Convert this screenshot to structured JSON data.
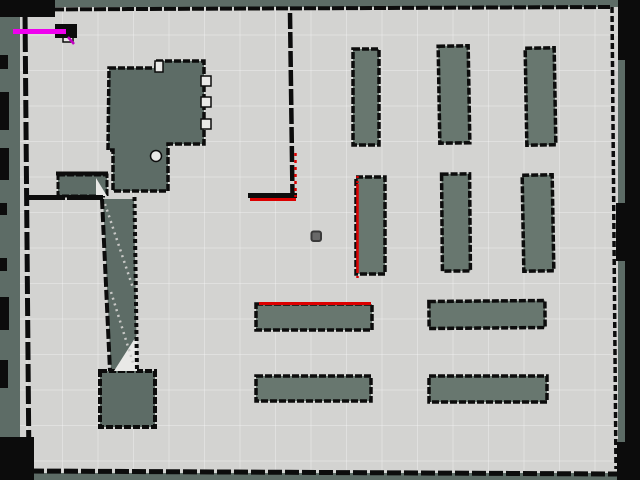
{
  "app": {
    "view": "occupancy-grid-map-view"
  },
  "map": {
    "colors": {
      "unknown": "#5d6c66",
      "floor": "#d3d3d1",
      "shelf": "#68776f",
      "wall": "#0c0c0c",
      "white": "#e9e9e7",
      "laser": "#dc0000",
      "path": "#ee00ee",
      "path_dim": "#c400c4",
      "robot_fill": "#696969",
      "robot_stroke": "#3a3a3a",
      "grid": "rgba(255,255,255,0.30)",
      "diag_dots": "#c9c9c7"
    },
    "viewport": {
      "width": 640,
      "height": 480
    },
    "floor": {
      "x": 20,
      "y": 7,
      "w": 598,
      "h": 466
    },
    "grid": {
      "offset_x": 27,
      "offset_y": 35,
      "spacing": 35.5
    },
    "slate_shapes": [
      {
        "name": "building-structure",
        "type": "path",
        "fill": "unknown",
        "stroke_w": 3.5,
        "d": "M109,68 L156,68 L156,61 L204,61 L204,144 L168,144 L168,191 L113,191 L113,150 L108,150 Z"
      },
      {
        "name": "side-room",
        "type": "rect",
        "fill": "unknown",
        "stroke_w": 3,
        "x": 58,
        "y": 175,
        "w": 49,
        "h": 21
      },
      {
        "name": "corridor-wedge",
        "type": "path",
        "fill": "unknown",
        "stroke_w": 0,
        "d": "M103,199 L134,199 L137,371 L111,371 Z"
      },
      {
        "name": "dock-block",
        "type": "rect",
        "fill": "unknown",
        "stroke_w": 4,
        "x": 100,
        "y": 371,
        "w": 55,
        "h": 56
      },
      {
        "name": "shelf-top-1",
        "type": "rect",
        "fill": "shelf",
        "stroke_w": 3.5,
        "x": 353,
        "y": 49,
        "w": 26,
        "h": 96
      },
      {
        "name": "shelf-top-2",
        "type": "rect",
        "fill": "shelf",
        "stroke_w": 3.5,
        "x": 439,
        "y": 46,
        "w": 30,
        "h": 97,
        "rot": -1
      },
      {
        "name": "shelf-top-3",
        "type": "rect",
        "fill": "shelf",
        "stroke_w": 3.5,
        "x": 526,
        "y": 48,
        "w": 29,
        "h": 97,
        "rot": -1
      },
      {
        "name": "shelf-mid-1",
        "type": "rect",
        "fill": "shelf",
        "stroke_w": 3.5,
        "x": 356,
        "y": 177,
        "w": 29,
        "h": 97
      },
      {
        "name": "shelf-mid-2",
        "type": "rect",
        "fill": "shelf",
        "stroke_w": 3.5,
        "x": 442,
        "y": 174,
        "w": 28,
        "h": 97,
        "rot": -0.5
      },
      {
        "name": "shelf-mid-3",
        "type": "rect",
        "fill": "shelf",
        "stroke_w": 3.5,
        "x": 523,
        "y": 175,
        "w": 30,
        "h": 96,
        "rot": -1
      },
      {
        "name": "shelf-low-1",
        "type": "rect",
        "fill": "shelf",
        "stroke_w": 3.5,
        "x": 256,
        "y": 304,
        "w": 116,
        "h": 26
      },
      {
        "name": "shelf-low-2",
        "type": "rect",
        "fill": "shelf",
        "stroke_w": 3.5,
        "x": 429,
        "y": 301,
        "w": 116,
        "h": 27,
        "rot": -0.5
      },
      {
        "name": "shelf-bottom-1",
        "type": "rect",
        "fill": "shelf",
        "stroke_w": 3.5,
        "x": 256,
        "y": 376,
        "w": 115,
        "h": 25
      },
      {
        "name": "shelf-bottom-2",
        "type": "rect",
        "fill": "shelf",
        "stroke_w": 3.5,
        "x": 429,
        "y": 376,
        "w": 118,
        "h": 26
      }
    ],
    "white_shapes": [
      {
        "name": "structure-door-notch-1",
        "type": "rect",
        "x": 201,
        "y": 76,
        "w": 10,
        "h": 10
      },
      {
        "name": "structure-door-notch-2",
        "type": "rect",
        "x": 201,
        "y": 97,
        "w": 10,
        "h": 10
      },
      {
        "name": "structure-door-notch-3",
        "type": "rect",
        "x": 201,
        "y": 119,
        "w": 10,
        "h": 10
      },
      {
        "name": "structure-top-notch",
        "type": "rect",
        "x": 155,
        "y": 61,
        "w": 8,
        "h": 11
      },
      {
        "name": "structure-round-notch",
        "type": "circle",
        "cx": 156,
        "cy": 156,
        "r": 5.5
      },
      {
        "name": "corridor-triangle",
        "type": "path",
        "d": "M114,371 L137,335 L137,371 Z"
      },
      {
        "name": "side-room-triangle",
        "type": "path",
        "d": "M96,178 L107,196 L96,196 Z"
      },
      {
        "name": "path-end-notch",
        "type": "rect",
        "x": 63,
        "y": 31,
        "w": 10,
        "h": 11
      }
    ],
    "dotted_diagonals": [
      {
        "name": "corridor-scan-diagonal-1",
        "x1": 105,
        "y1": 204,
        "x2": 133,
        "y2": 288
      },
      {
        "name": "corridor-scan-diagonal-2",
        "x1": 111,
        "y1": 292,
        "x2": 134,
        "y2": 366
      }
    ],
    "walls": [
      {
        "name": "wall-top",
        "x1": 24,
        "y1": 9.5,
        "x2": 612,
        "y2": 7,
        "w": 4,
        "dash": "12 2"
      },
      {
        "name": "wall-right",
        "x1": 612,
        "y1": 7,
        "x2": 616,
        "y2": 469,
        "w": 3.5,
        "dash": "6 3"
      },
      {
        "name": "wall-bottom",
        "x1": 30,
        "y1": 471,
        "x2": 617,
        "y2": 474,
        "w": 5,
        "dash": "14 3"
      },
      {
        "name": "wall-left",
        "x1": 25,
        "y1": 12,
        "x2": 29,
        "y2": 470,
        "w": 5,
        "dash": "18 4"
      },
      {
        "name": "wall-center-vertical",
        "x1": 290,
        "y1": 13,
        "x2": 292.5,
        "y2": 196,
        "w": 4.5,
        "dash": "16 3"
      },
      {
        "name": "wall-l-corner-horizontal",
        "x1": 248,
        "y1": 195.5,
        "x2": 297,
        "y2": 195.5,
        "w": 5,
        "dash": ""
      },
      {
        "name": "wall-left-room-top",
        "x1": 25,
        "y1": 197.5,
        "x2": 103,
        "y2": 197.5,
        "w": 5,
        "dash": "40 2"
      },
      {
        "name": "wall-side-room-top",
        "x1": 56,
        "y1": 173.5,
        "x2": 108,
        "y2": 173.5,
        "w": 4,
        "dash": ""
      },
      {
        "name": "wall-corridor-left",
        "x1": 102,
        "y1": 199,
        "x2": 110,
        "y2": 371,
        "w": 4,
        "dash": "10 3"
      },
      {
        "name": "wall-corridor-right",
        "x1": 134.5,
        "y1": 197,
        "x2": 137,
        "y2": 372,
        "w": 4,
        "dash": "4 3"
      }
    ],
    "frame_patches": [
      {
        "name": "frame-top-left",
        "x": 0,
        "y": 0,
        "w": 55,
        "h": 17
      },
      {
        "name": "frame-left-1",
        "x": 0,
        "y": 55,
        "w": 8,
        "h": 14
      },
      {
        "name": "frame-left-2",
        "x": 0,
        "y": 92,
        "w": 9,
        "h": 38
      },
      {
        "name": "frame-left-3",
        "x": 0,
        "y": 148,
        "w": 9,
        "h": 32
      },
      {
        "name": "frame-left-4",
        "x": 0,
        "y": 203,
        "w": 7,
        "h": 12
      },
      {
        "name": "frame-left-5",
        "x": 0,
        "y": 258,
        "w": 7,
        "h": 13
      },
      {
        "name": "frame-left-6",
        "x": 0,
        "y": 297,
        "w": 9,
        "h": 33
      },
      {
        "name": "frame-left-7",
        "x": 0,
        "y": 360,
        "w": 8,
        "h": 28
      },
      {
        "name": "frame-bottom-left-corner",
        "x": 0,
        "y": 437,
        "w": 34,
        "h": 43
      },
      {
        "name": "frame-right-band",
        "x": 625,
        "y": 0,
        "w": 15,
        "h": 480
      },
      {
        "name": "frame-top-right",
        "x": 618,
        "y": 0,
        "w": 22,
        "h": 60
      },
      {
        "name": "frame-right-mid",
        "x": 616,
        "y": 203,
        "w": 12,
        "h": 58
      },
      {
        "name": "frame-bottom-right",
        "x": 617,
        "y": 442,
        "w": 23,
        "h": 38
      },
      {
        "name": "wall-blob-top-left",
        "x": 55,
        "y": 24,
        "w": 22,
        "h": 14
      }
    ],
    "laser_segments": [
      {
        "name": "scan-l-corner-horizontal",
        "x1": 250,
        "y1": 199.5,
        "x2": 296,
        "y2": 199.5,
        "w": 3,
        "dash": ""
      },
      {
        "name": "scan-l-corner-vertical",
        "x1": 295.5,
        "y1": 153,
        "x2": 295.5,
        "y2": 197,
        "w": 2.5,
        "dash": "3 4"
      },
      {
        "name": "scan-shelf-mid-1-edge",
        "x1": 357.5,
        "y1": 184,
        "x2": 357.5,
        "y2": 271,
        "w": 2.5,
        "dash": ""
      },
      {
        "name": "scan-shelf-mid-1-tail-top",
        "x1": 357.5,
        "y1": 176,
        "x2": 357.5,
        "y2": 184,
        "w": 2.5,
        "dash": "2 3"
      },
      {
        "name": "scan-shelf-mid-1-tail-bottom",
        "x1": 357.5,
        "y1": 271,
        "x2": 357.5,
        "y2": 278,
        "w": 2.5,
        "dash": "2 3"
      },
      {
        "name": "scan-shelf-low-1-top",
        "x1": 259,
        "y1": 303.5,
        "x2": 371,
        "y2": 303.5,
        "w": 3,
        "dash": ""
      }
    ],
    "path_overlay": {
      "segments": [
        {
          "name": "planned-path-line",
          "x1": 13,
          "y1": 31.5,
          "x2": 66,
          "y2": 31.5,
          "w": 5,
          "color": "path"
        },
        {
          "name": "planned-path-arrow",
          "x1": 68,
          "y1": 37,
          "x2": 74,
          "y2": 44,
          "w": 2.5,
          "color": "path_dim"
        }
      ]
    },
    "robot": {
      "x": 311.5,
      "y": 231.5,
      "w": 9.5,
      "h": 9.5,
      "rx": 2
    }
  }
}
